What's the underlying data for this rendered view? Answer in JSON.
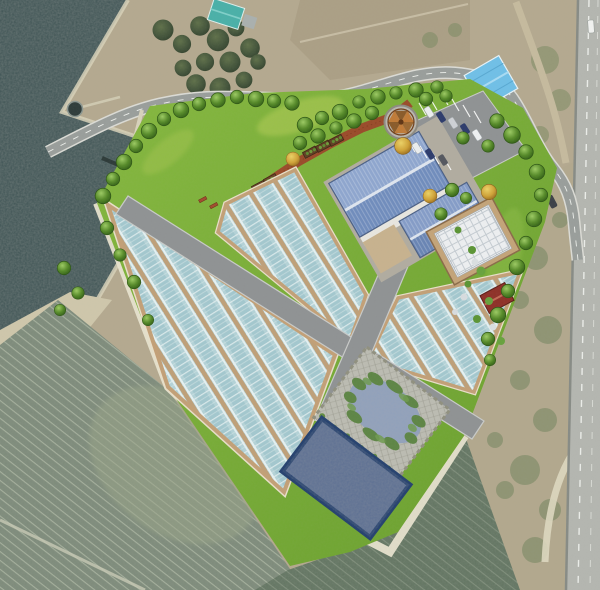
{
  "scene": {
    "title": "Greenhouse farm complex site plan over aerial photo",
    "type": "aerial-site-plan-render",
    "labels": {
      "water": "lake water area",
      "farm_fields": "plowed farm fields",
      "highway": "highway at right edge",
      "access_road": "curved access road",
      "site": "rendered development site with lawn",
      "greenhouse_left": "left greenhouse block",
      "greenhouse_center": "center greenhouse block",
      "greenhouse_right": "right greenhouse block",
      "internal_roads": "internal site roads",
      "main_building": "main building with blue metal roof",
      "glasshouse": "white glass house",
      "red_shed": "red roofed shed",
      "gazebo": "hexagonal gazebo",
      "parking": "parking lot with cars",
      "pond": "ecological pond with plantings",
      "reservoir": "rectangular water reservoir",
      "deck": "wooden boardwalk",
      "existing_blue_warehouse": "existing blue-roofed warehouse",
      "existing_teal_building": "existing teal-roofed building",
      "existing_red_house": "existing red-roofed house"
    },
    "palette": {
      "water_dark": "#3e5354",
      "field_green": "#7c8a79",
      "field_dark": "#60735f",
      "dirt_tan": "#b6ab92",
      "lawn_green": "#7ab33a",
      "greenhouse_blue": "#b7d6da",
      "greenhouse_gap_tan": "#bfa078",
      "road_gray": "#8f9293",
      "roof_blue_light": "#8ea6cf",
      "roof_blue_dark": "#6f8cbd",
      "glasshouse_white": "#eef0f2",
      "deck_brown": "#9a4a28",
      "gazebo_orange": "#c07a36",
      "reservoir_blue": "#5a6d92",
      "reservoir_border": "#24406e",
      "pond_blue": "#8fa0bd",
      "shed_red": "#8e2f26",
      "berm_pale": "#e8e3cf"
    },
    "inventory": {
      "greenhouse_blocks": 3,
      "greenhouse_strips_approx": 19,
      "parked_cars": 8,
      "vehicles_on_roads": 2,
      "rendered_trees_approx": 60,
      "yellow_autumn_trees": 4,
      "benches": 5,
      "planter_boxes": 6,
      "gazebos": 1,
      "ponds": 1,
      "reservoirs": 1
    }
  }
}
